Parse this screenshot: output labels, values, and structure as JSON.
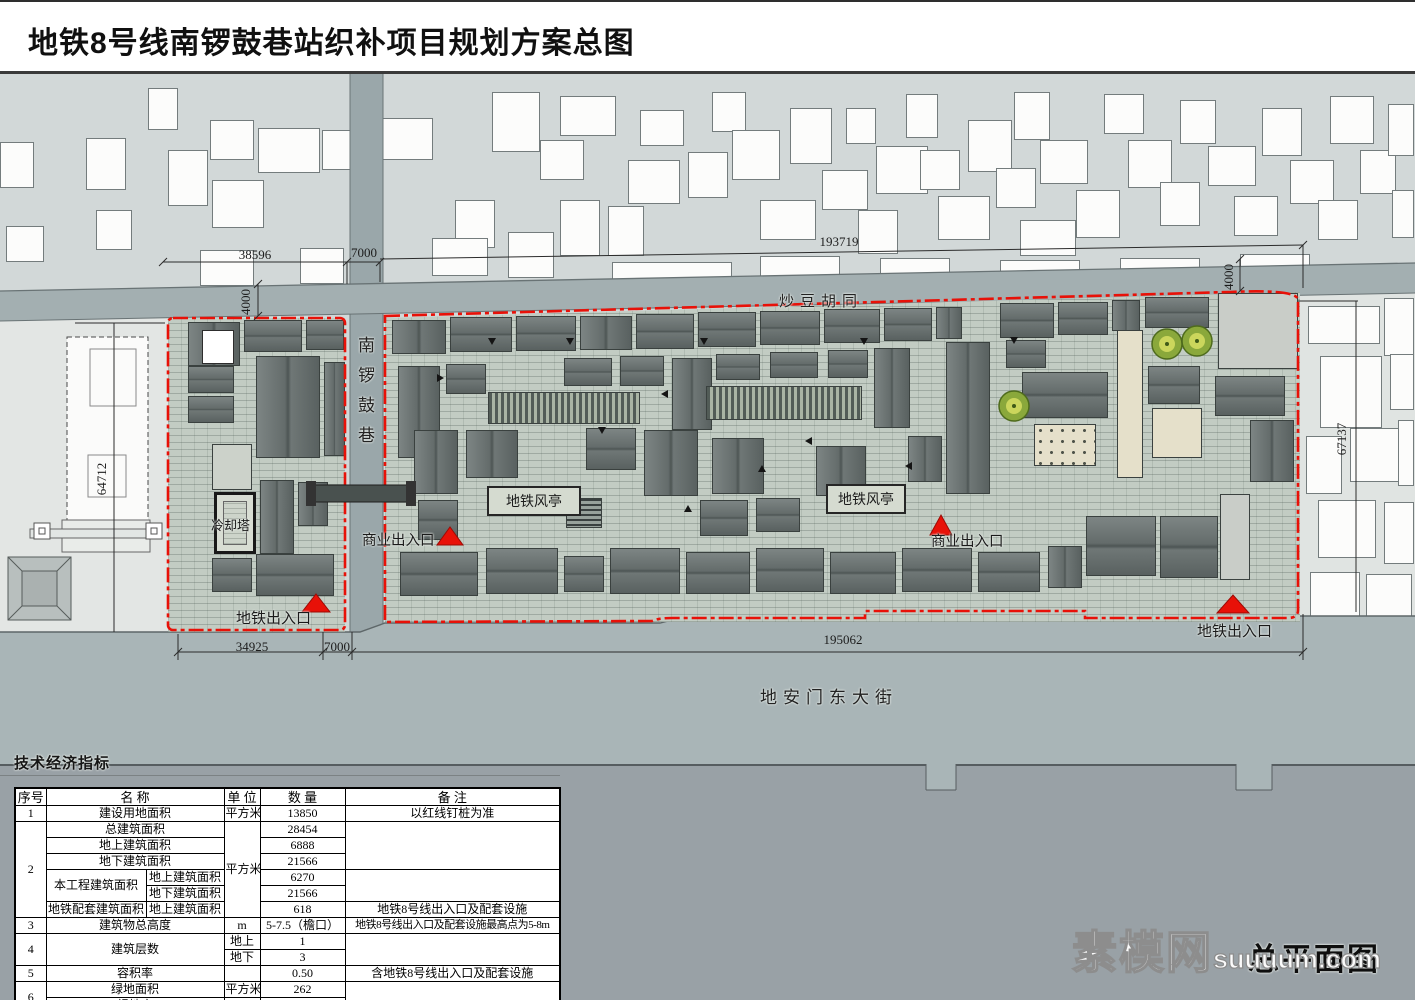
{
  "title": "地铁8号线南锣鼓巷站织补项目规划方案总图",
  "plan": {
    "streets": {
      "north": "炒豆胡同",
      "vertical": "南锣鼓巷",
      "south": "地安门东大街"
    },
    "labels": {
      "cooling_tower": "冷却塔",
      "vent1": "地铁风亭",
      "vent2": "地铁风亭",
      "commercial_entrance_left": "商业出入口",
      "commercial_entrance_right": "商业出入口",
      "metro_entrance_left": "地铁出入口",
      "metro_entrance_right": "地铁出入口"
    },
    "dimensions": {
      "top_left": "38596",
      "top_road": "7000",
      "top_right": "193719",
      "north_road_width_left": "4000",
      "north_road_width_right": "4000",
      "west_building": "64712",
      "east_block": "67137",
      "bottom_left": "34925",
      "bottom_road": "7000",
      "bottom_right": "195062"
    },
    "colors": {
      "boundary_red": "#e81108",
      "roof_gray": "#68706f",
      "paving_green": "#c2ccc3",
      "road_gray": "#a3afb1"
    }
  },
  "table": {
    "section_title": "技术经济指标",
    "headers": {
      "no": "序号",
      "name": "名  称",
      "unit": "单 位",
      "qty": "数  量",
      "note": "备  注"
    },
    "r1": {
      "no": "1",
      "name": "建设用地面积",
      "unit": "平方米",
      "qty": "13850",
      "note": "以红线钉桩为准"
    },
    "r2": {
      "no": "2",
      "unit": "平方米",
      "total": {
        "name": "总建筑面积",
        "qty": "28454"
      },
      "above": {
        "name": "地上建筑面积",
        "qty": "6888"
      },
      "below": {
        "name": "地下建筑面积",
        "qty": "21566"
      },
      "project": {
        "name": "本工程建筑面积",
        "above_name": "地上建筑面积",
        "above_qty": "6270",
        "below_name": "地下建筑面积",
        "below_qty": "21566"
      },
      "metro": {
        "name": "地铁配套建筑面积",
        "above_name": "地上建筑面积",
        "qty": "618",
        "note": "地铁8号线出入口及配套设施"
      }
    },
    "r3": {
      "no": "3",
      "name": "建筑物总高度",
      "unit": "m",
      "qty": "5-7.5（檐口）",
      "note": "地铁8号线出入口及配套设施最高点为5-8m"
    },
    "r4": {
      "no": "4",
      "name": "建筑层数",
      "above_label": "地上",
      "above_qty": "1",
      "below_label": "地下",
      "below_qty": "3"
    },
    "r5": {
      "no": "5",
      "name": "容积率",
      "qty": "0.50",
      "note": "含地铁8号线出入口及配套设施"
    },
    "r6": {
      "no": "6",
      "green_area": {
        "name": "绿地面积",
        "unit": "平方米",
        "qty": "262"
      },
      "green_rate": {
        "name": "绿地率",
        "qty": "1.9%"
      }
    }
  },
  "watermark": {
    "cn": "素模网",
    "latin": "suuuum.com"
  },
  "drawing_label": "总平面图"
}
